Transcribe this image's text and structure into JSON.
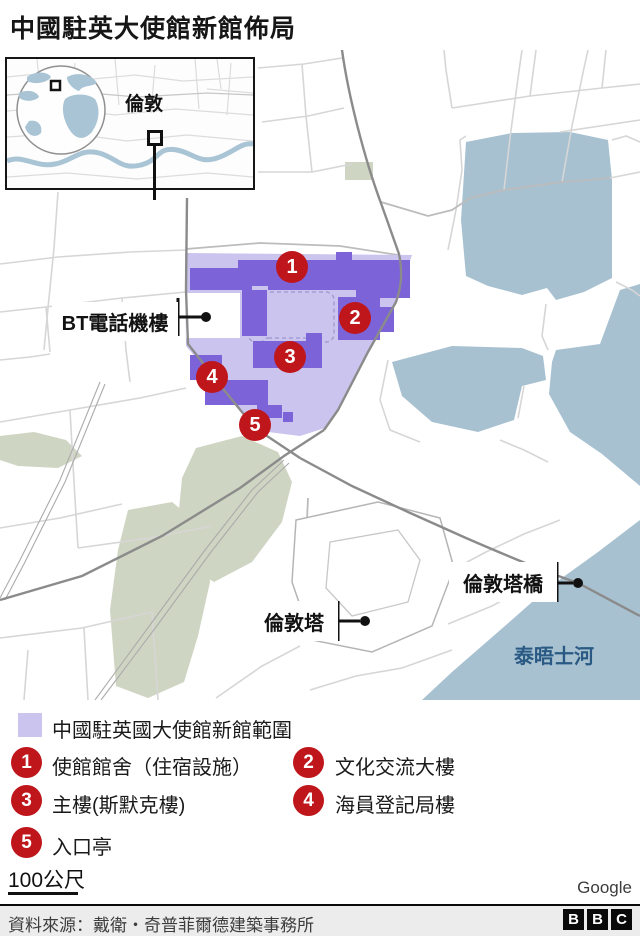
{
  "title": "中國駐英大使館新館佈局",
  "inset": {
    "city_label": "倫敦"
  },
  "map": {
    "labels": {
      "bt_exchange": "BT電話機樓",
      "tower_bridge": "倫敦塔橋",
      "tower_of_london": "倫敦塔",
      "river": "泰晤士河"
    },
    "markers": [
      "1",
      "2",
      "3",
      "4",
      "5"
    ]
  },
  "legend": {
    "area_label": "中國駐英國大使館新館範圍",
    "items": [
      {
        "num": "1",
        "label": "使館館舍（住宿設施）"
      },
      {
        "num": "2",
        "label": "文化交流大樓"
      },
      {
        "num": "3",
        "label": "主樓(斯默克樓)"
      },
      {
        "num": "4",
        "label": "海員登記局樓"
      },
      {
        "num": "5",
        "label": "入口亭"
      }
    ]
  },
  "scale": {
    "label": "100公尺"
  },
  "attribution": "Google",
  "footer": {
    "source": "資料來源：戴衛・奇普菲爾德建築事務所",
    "logo": [
      "B",
      "B",
      "C"
    ]
  },
  "colors": {
    "embassy_area_light": "#cac4ee",
    "embassy_building_dark": "#7c63d8",
    "marker_red": "#bf161c",
    "water_blue": "#a7c1d1",
    "green_space": "#cfd5c3",
    "river_label_blue": "#2a5a84"
  }
}
